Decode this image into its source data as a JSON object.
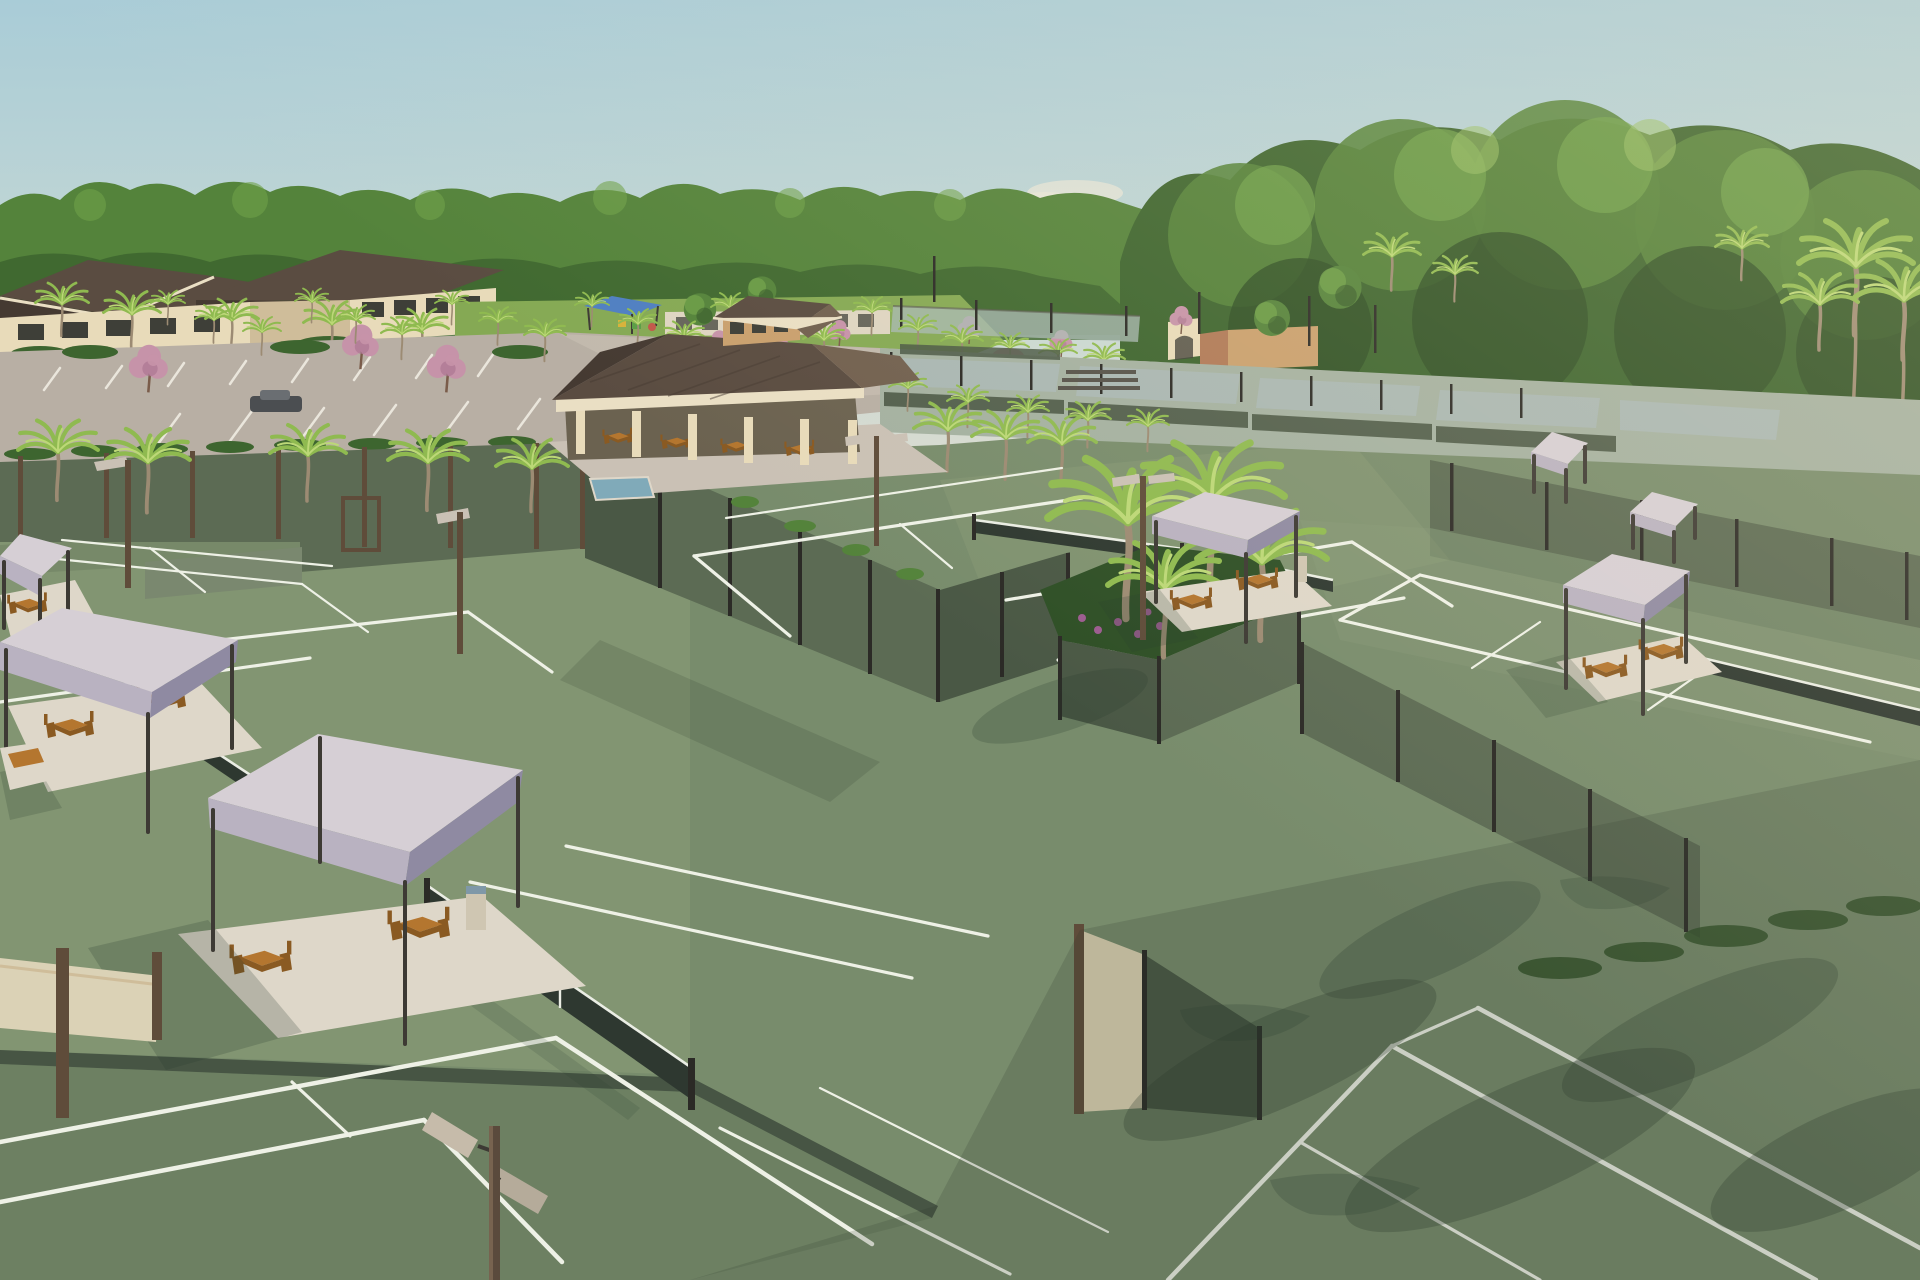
{
  "scene": {
    "description": "Aerial architectural rendering of a racquet-sports club: many green hard courts with white lines separated by dark sage windscreen fences, lavender shade tents with wooden picnic tables on paver pads, a central open-air pavilion with brown hip roof and cupola, clubhouse buildings at the left, a palm-lined parking lot, distant pickleball courts, pink flowering trees, lawns and a dense tree line under a hazy late-afternoon sky.",
    "style": "photorealistic 3D rendering",
    "time_of_day": "late afternoon, warm sunlight from the right",
    "counts": {
      "shade_tents": 7,
      "visible_nets": 5,
      "clubhouse_buildings": 2,
      "pavilion": 1,
      "light_poles": 5
    }
  },
  "palette": {
    "sky_top": "#a9ccd7",
    "sky_mid": "#c6d8d4",
    "sky_horizon": "#e4ddcf",
    "cloud": "#f2ead9",
    "tree_deep": "#2e4f26",
    "tree_dark": "#3d652f",
    "tree_mid": "#54833b",
    "tree_light": "#6fa24a",
    "tree_glow": "#97c065",
    "palm_frond": "#8fba50",
    "palm_frond_light": "#bcd877",
    "palm_trunk": "#9c8b73",
    "pink_bloom": "#c693a9",
    "pink_bloom_dark": "#aa7490",
    "lawn": "#85a954",
    "lawn_light": "#9fbf68",
    "roof_dark": "#453a32",
    "roof_mid": "#5a4c41",
    "roof_light": "#71604f",
    "roof_edge": "#eadfc4",
    "wall_cream": "#e8dbba",
    "wall_shadow": "#cfbd9a",
    "wall_tan": "#c9a06e",
    "window_dark": "#3e3f38",
    "pavement": "#b8afa4",
    "pavement_light": "#cac1b5",
    "road_line": "#eae6dc",
    "court_sun": "#8a9c79",
    "court_mid": "#788c6c",
    "court_shade": "#5e7056",
    "court_dark": "#475544",
    "court_distant": "#a4b1a1",
    "court_blue": "#aab9b6",
    "line_white": "#eef1e6",
    "fence_fabric": "#5c6b54",
    "fence_fabric_light": "#7a886f",
    "fence_fabric_dark": "#4a5845",
    "fence_post": "#2b2a26",
    "fence_post_brown": "#5f4c3a",
    "net_dark": "#2e3830",
    "net_tape": "#eaede4",
    "tent_light": "#d6cfd5",
    "tent_mid": "#b9b2c1",
    "tent_dark": "#8f8aa2",
    "tent_leg": "#3d3a34",
    "pad_light": "#ded7c9",
    "pad_shadow": "#bab3a6",
    "wood": "#b4762f",
    "wood_dark": "#8a5a22",
    "shadow_col": "#2a3a2c",
    "water_blue": "#80aab9",
    "play_blue": "#4f7fc2",
    "car_dark": "#4b4e51",
    "flower_purple": "#9c5c90",
    "sun_warm": "#ffe9c2"
  }
}
